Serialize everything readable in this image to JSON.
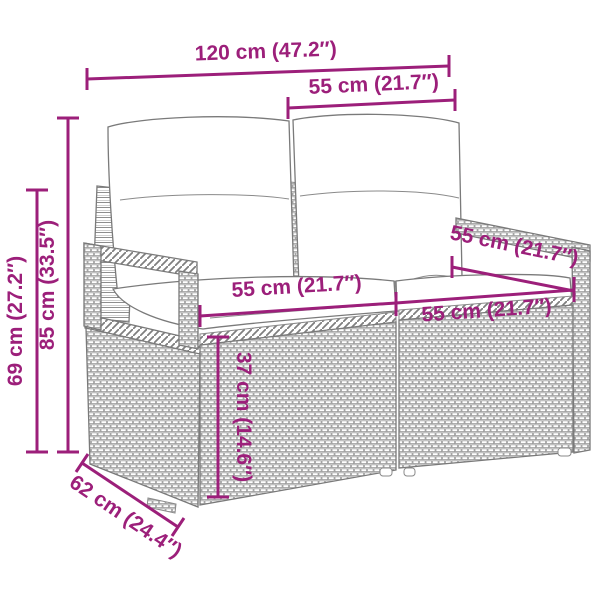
{
  "colors": {
    "accent": "#9C1F7A",
    "drawing_line": "#7a7a7a",
    "background": "#ffffff"
  },
  "illustration": {
    "subject": "wicker-two-seater-sofa-with-cushions"
  },
  "dimensions": {
    "total_width": {
      "label": "120 cm (47.2″)"
    },
    "top_width": {
      "label": "55 cm (21.7″)"
    },
    "height_overall": {
      "label": "85 cm (33.5″)"
    },
    "height_arm": {
      "label": "69 cm (27.2″)"
    },
    "seat_left_width": {
      "label": "55 cm (21.7″)"
    },
    "seat_right_width": {
      "label": "55 cm (21.7″)"
    },
    "seat_depth": {
      "label": "55 cm (21.7″)"
    },
    "seat_height": {
      "label": "37 cm (14.6″)"
    },
    "depth": {
      "label": "62 cm (24.4″)"
    }
  }
}
